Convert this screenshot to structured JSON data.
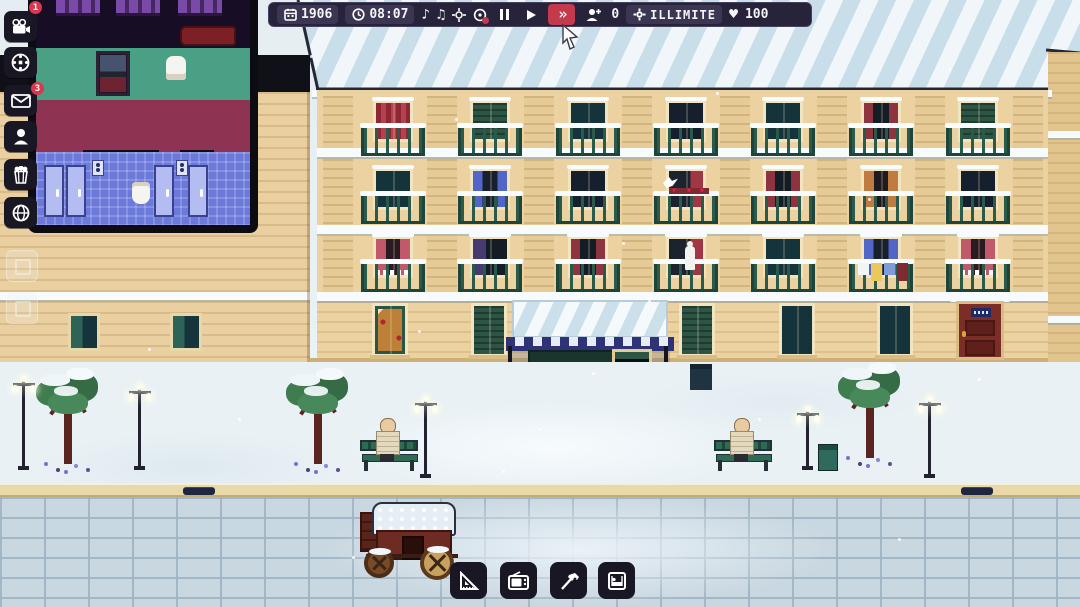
{
  "hud": {
    "date": {
      "icon": "calendar-icon",
      "value": "1906"
    },
    "time": {
      "icon": "clock-icon",
      "value": "08:07"
    },
    "sound_icons": [
      "music-note-icon",
      "music-notes-icon",
      "center-view-icon",
      "zoom-toggle-icon"
    ],
    "playback": {
      "pause": "pause-icon",
      "play": "play-icon",
      "fast_forward": "fast-forward-icon",
      "fast_forward_glyph": "»",
      "active": "fast_forward"
    },
    "population": {
      "icon": "person-plus-icon",
      "value": "0"
    },
    "money": {
      "icon": "gear-coin-icon",
      "value": "ILLIMITE"
    },
    "hearts": {
      "icon": "heart-icon",
      "glyph": "♥",
      "value": "100"
    }
  },
  "sidebar": {
    "items": [
      {
        "icon": "movie-camera-icon",
        "badge": "1"
      },
      {
        "icon": "film-reel-icon",
        "badge": ""
      },
      {
        "icon": "mail-icon",
        "badge": "3"
      },
      {
        "icon": "person-icon",
        "badge": ""
      },
      {
        "icon": "popcorn-icon",
        "badge": ""
      },
      {
        "icon": "globe-icon",
        "badge": ""
      }
    ]
  },
  "toolbar": {
    "items": [
      {
        "icon": "set-square-icon"
      },
      {
        "icon": "retro-tv-icon"
      },
      {
        "icon": "hammer-tools-icon"
      },
      {
        "icon": "bed-room-icon"
      }
    ]
  },
  "scene": {
    "window_columns": [
      393,
      490,
      588,
      686,
      783,
      881,
      978
    ],
    "window_rows": [
      100,
      168,
      236
    ],
    "window_variants": [
      [
        "red_stripes",
        "green_shutters",
        "dark_teal",
        "dark_navy",
        "dark_teal",
        "maroon_curtains",
        "green_shutters"
      ],
      [
        "dark_teal",
        "blue_curtains",
        "dark_navy",
        "bird_red",
        "maroon_curtains",
        "orange_curtains",
        "dark_navy"
      ],
      [
        "pink_lace",
        "purple_curtain",
        "maroon_curtains",
        "figure_red",
        "dark_teal",
        "blue_laundry",
        "pink_lace"
      ]
    ],
    "ground_windows": [
      {
        "x": 390,
        "variant": "amber_shop"
      },
      {
        "x": 489,
        "variant": "green_shutters"
      },
      {
        "x": 697,
        "variant": "green_shutters"
      },
      {
        "x": 797,
        "variant": "dark_teal"
      },
      {
        "x": 895,
        "variant": "dark_teal"
      }
    ],
    "left_windows": [
      {
        "x": 68
      },
      {
        "x": 170
      }
    ],
    "trees": [
      {
        "x": 34,
        "y": 364
      },
      {
        "x": 284,
        "y": 364
      },
      {
        "x": 836,
        "y": 358
      }
    ],
    "lamps": [
      {
        "x": 12,
        "y": 376,
        "h": 94
      },
      {
        "x": 128,
        "y": 384,
        "h": 86
      },
      {
        "x": 414,
        "y": 396,
        "h": 82
      },
      {
        "x": 796,
        "y": 406,
        "h": 64
      },
      {
        "x": 918,
        "y": 396,
        "h": 82
      }
    ],
    "benches": [
      {
        "x": 360,
        "y": 434
      },
      {
        "x": 714,
        "y": 434
      }
    ],
    "bins": [
      {
        "x": 690,
        "y": 364,
        "type": "square"
      },
      {
        "x": 818,
        "y": 444,
        "type": "lidded"
      }
    ],
    "drains": [
      {
        "x": 183
      },
      {
        "x": 961
      }
    ],
    "laundry_colors": [
      "#f2f4f6",
      "#e8c95a",
      "#7f9bd8",
      "#7e2a30"
    ],
    "snowflakes": [
      [
        310,
        55
      ],
      [
        455,
        118
      ],
      [
        562,
        148
      ],
      [
        622,
        242
      ],
      [
        716,
        92
      ],
      [
        948,
        68
      ],
      [
        868,
        198
      ],
      [
        418,
        330
      ],
      [
        648,
        300
      ],
      [
        238,
        418
      ],
      [
        538,
        428
      ],
      [
        758,
        418
      ],
      [
        978,
        378
      ],
      [
        148,
        348
      ],
      [
        352,
        556
      ],
      [
        898,
        538
      ],
      [
        502,
        470
      ],
      [
        592,
        372
      ]
    ]
  }
}
